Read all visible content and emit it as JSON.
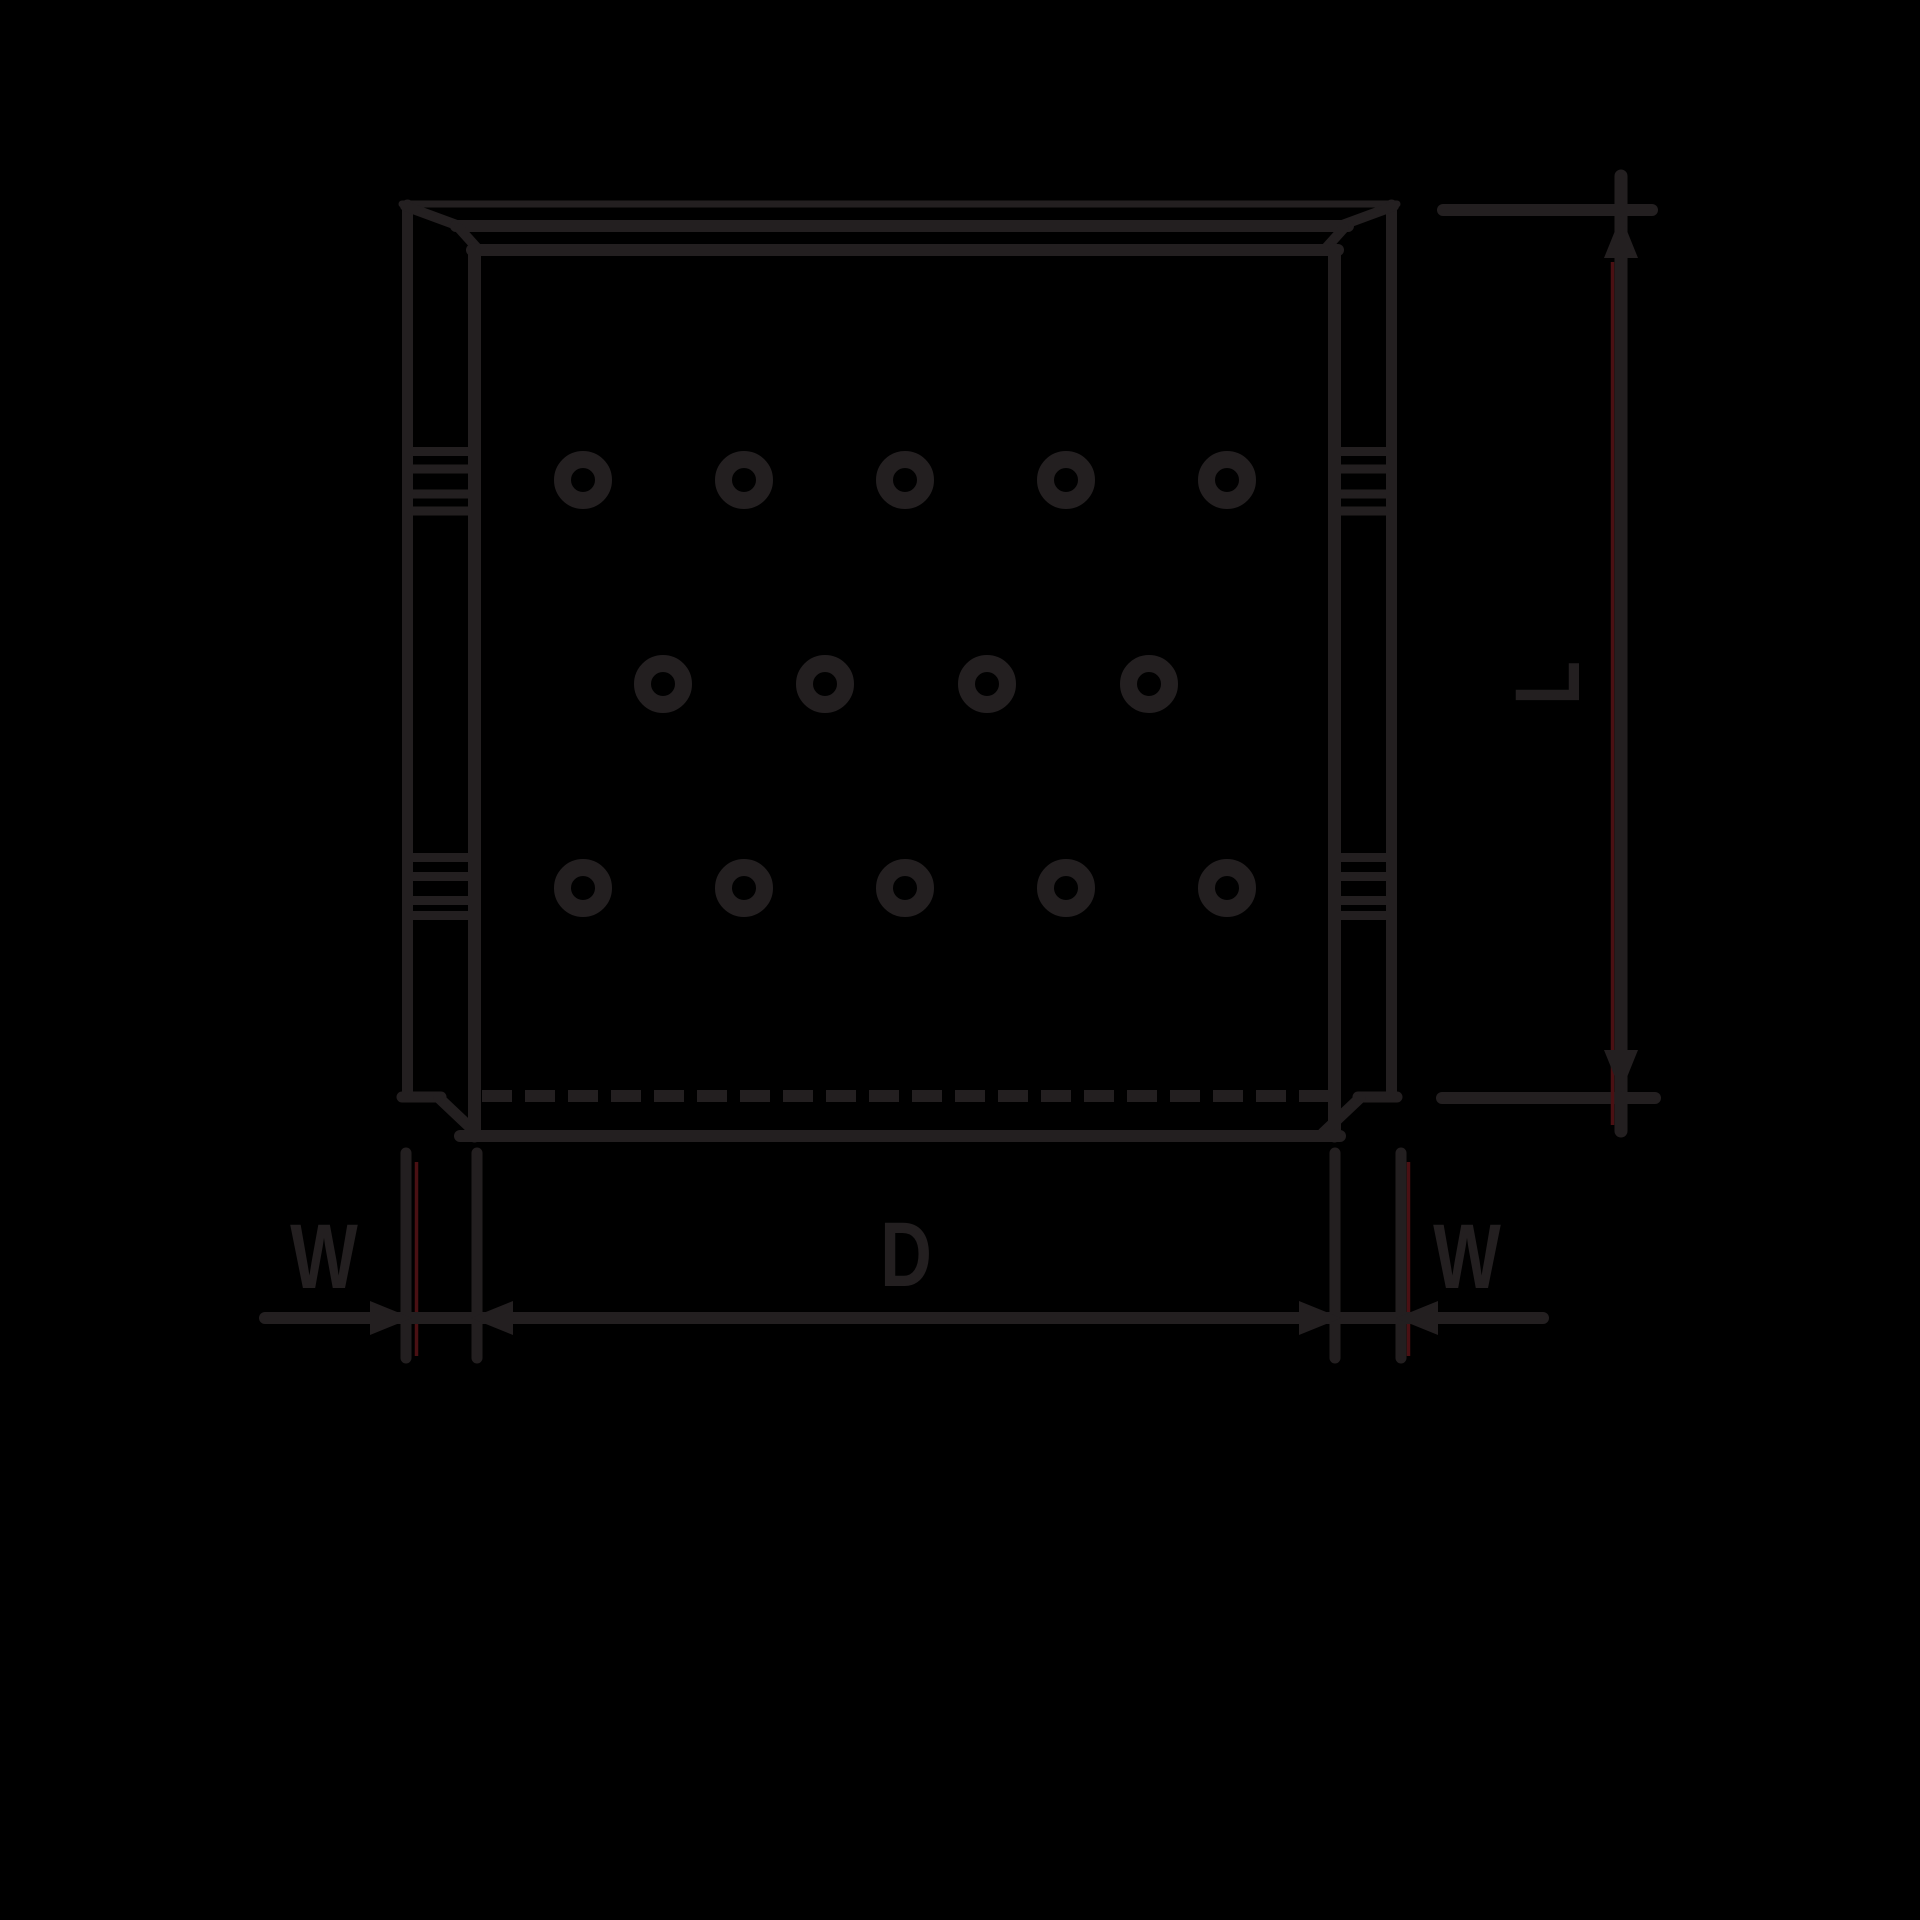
{
  "window": {
    "width": 1920,
    "height": 1920,
    "background_color": "#000000"
  },
  "drawing": {
    "type": "technical-line-drawing",
    "subject": "perforated split bushing, side view with dimension callouts",
    "line_color": "#231f20",
    "accent_line_color": "#4a1013",
    "labels": {
      "wall_left": "W",
      "inner_diameter": "D",
      "wall_right": "W",
      "length": "L"
    },
    "perforations": {
      "rows": 3,
      "holes_per_row": [
        5,
        4,
        5
      ]
    }
  }
}
